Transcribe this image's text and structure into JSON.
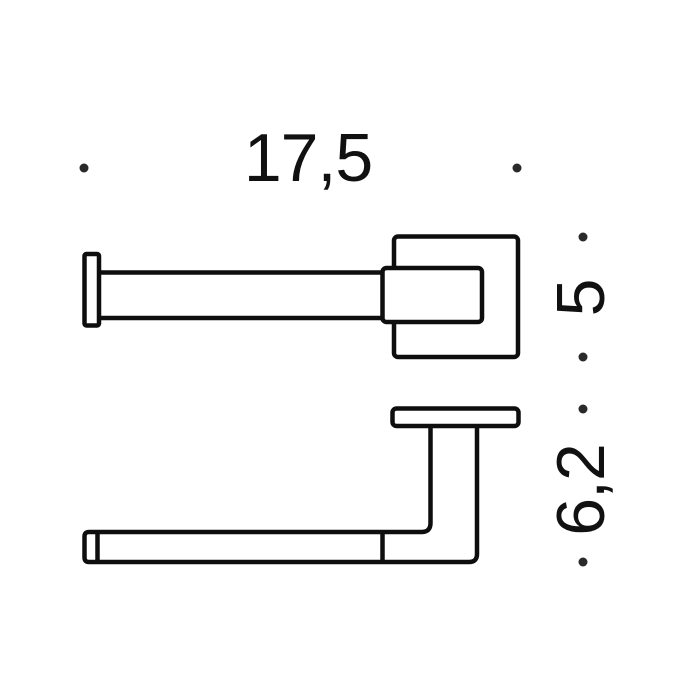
{
  "drawing": {
    "background_color": "#ffffff",
    "line_color": "#0e0e0e",
    "dot_color": "#2a2a2a",
    "text_color": "#111111",
    "dimensions": {
      "width_label": "17,5",
      "plate_label": "5",
      "height_label": "6,2"
    }
  }
}
